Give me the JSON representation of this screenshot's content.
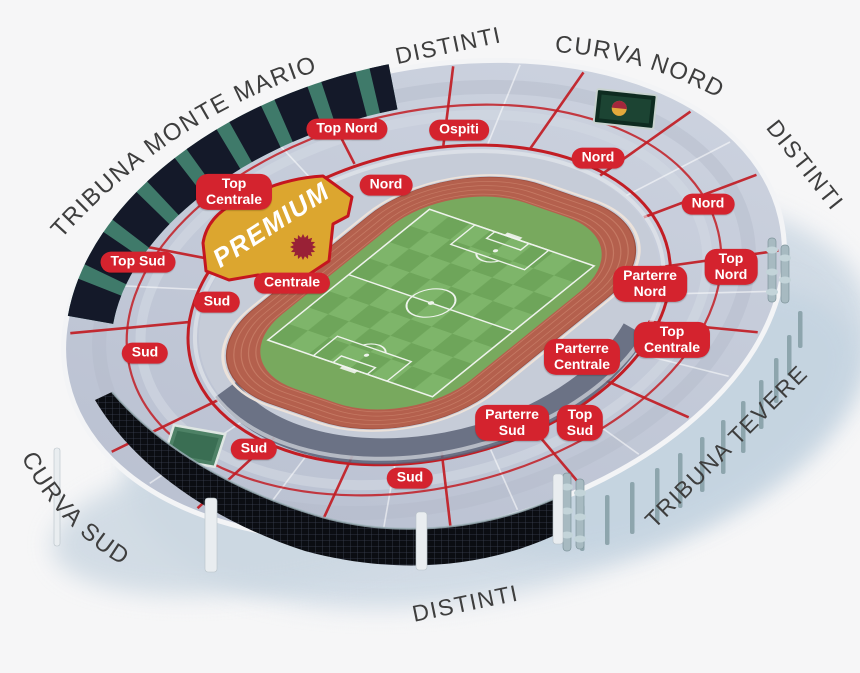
{
  "stadium": {
    "premium_label": "PREMIUM",
    "outer_labels": [
      {
        "id": "tribuna-monte-mario",
        "text": "TRIBUNA MONTE MARIO"
      },
      {
        "id": "distinti-nw",
        "text": "DISTINTI"
      },
      {
        "id": "curva-nord",
        "text": "CURVA NORD"
      },
      {
        "id": "distinti-ne",
        "text": "DISTINTI"
      },
      {
        "id": "tribuna-tevere",
        "text": "TRIBUNA TEVERE"
      },
      {
        "id": "distinti-sud",
        "text": "DISTINTI"
      },
      {
        "id": "curva-sud",
        "text": "CURVA SUD"
      }
    ],
    "section_badges": [
      {
        "id": "top-nord-west",
        "label": "Top Nord"
      },
      {
        "id": "ospiti",
        "label": "Ospiti"
      },
      {
        "id": "nord-top",
        "label": "Nord"
      },
      {
        "id": "nord-west",
        "label": "Nord"
      },
      {
        "id": "top-centrale-west",
        "label": "Top\nCentrale"
      },
      {
        "id": "nord-east",
        "label": "Nord"
      },
      {
        "id": "top-sud-west",
        "label": "Top Sud"
      },
      {
        "id": "top-nord-east",
        "label": "Top\nNord"
      },
      {
        "id": "centrale",
        "label": "Centrale"
      },
      {
        "id": "parterre-nord",
        "label": "Parterre\nNord"
      },
      {
        "id": "sud-west-upper",
        "label": "Sud"
      },
      {
        "id": "top-centrale-east",
        "label": "Top\nCentrale"
      },
      {
        "id": "sud-west-lower",
        "label": "Sud"
      },
      {
        "id": "parterre-centrale",
        "label": "Parterre\nCentrale"
      },
      {
        "id": "parterre-sud",
        "label": "Parterre\nSud"
      },
      {
        "id": "top-sud-east",
        "label": "Top\nSud"
      },
      {
        "id": "sud-south-west",
        "label": "Sud"
      },
      {
        "id": "sud-south",
        "label": "Sud"
      }
    ],
    "colors": {
      "badge_red": "#d4232e",
      "section_outline_red": "#c21d24",
      "premium_gold": "#dca62f",
      "premium_star": "#992136",
      "stands_gray": "#c3cad8",
      "track_terracotta": "#b4604d",
      "pitch_green_light": "#7eb56a",
      "pitch_green_dark": "#6ea55a",
      "label_gray": "#3e3e3e"
    }
  }
}
